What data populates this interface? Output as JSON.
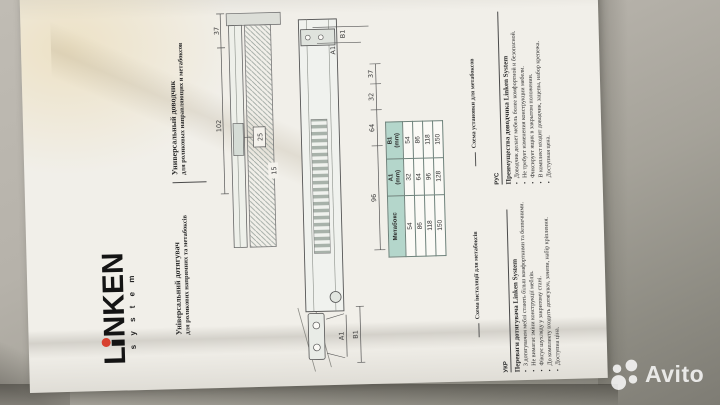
{
  "photo": {
    "watermark_text": "Avito"
  },
  "document": {
    "brand": {
      "logo_l": "L",
      "logo_rest": "NKEN",
      "logo_sub": "s y s t e m",
      "dot_color": "#d8402f"
    },
    "title_ua_1": "Універсальний дотягувач",
    "title_ua_2": "для роликових напрямних та метабоксів",
    "title_ru_1": "Универсальный доводчик",
    "title_ru_2": "для роликовых направляющих и метабоксов",
    "drawing1": {
      "dim_102": "102",
      "dim_37": "37",
      "dim_25": "25",
      "dim_15": "15"
    },
    "drawing2": {
      "dim_96": "96",
      "dim_64": "64",
      "dim_32": "32",
      "dim_37": "37",
      "a1": "A1",
      "b1": "B1"
    },
    "table": {
      "headers": [
        "Метабокс",
        "A1\n(mm)",
        "B1\n(mm)"
      ],
      "rows": [
        [
          "54",
          "32",
          "54"
        ],
        [
          "86",
          "64",
          "86"
        ],
        [
          "118",
          "96",
          "118"
        ],
        [
          "150",
          "128",
          "150"
        ]
      ]
    },
    "caption_ua": "Схема інсталяції для метабоксів",
    "caption_ru": "Схема установки для метабоксов",
    "benefits_ua": {
      "lang": "УКР",
      "heading": "Переваги дотягувача Linken System",
      "items": [
        "З дотягувачем меблі стають більш комфортними та безпечними.",
        "Не вимагає зміни конструкції меблів.",
        "Фіксує шухляду у закритому стані.",
        "До комплекту входить дотягувач, зачепи, набір кріплення.",
        "Доступна ціна."
      ]
    },
    "benefits_ru": {
      "lang": "РУС",
      "heading": "Преимущества доводчика Linken System",
      "items": [
        "Доводчик делает мебель более комфортной и безопасной.",
        "Не требует изменения конструкции мебели.",
        "Фиксирует ящик в закрытом положении.",
        "В комплект входит доводчик, зацепы, набор крепежа.",
        "Доступная цена."
      ]
    }
  }
}
